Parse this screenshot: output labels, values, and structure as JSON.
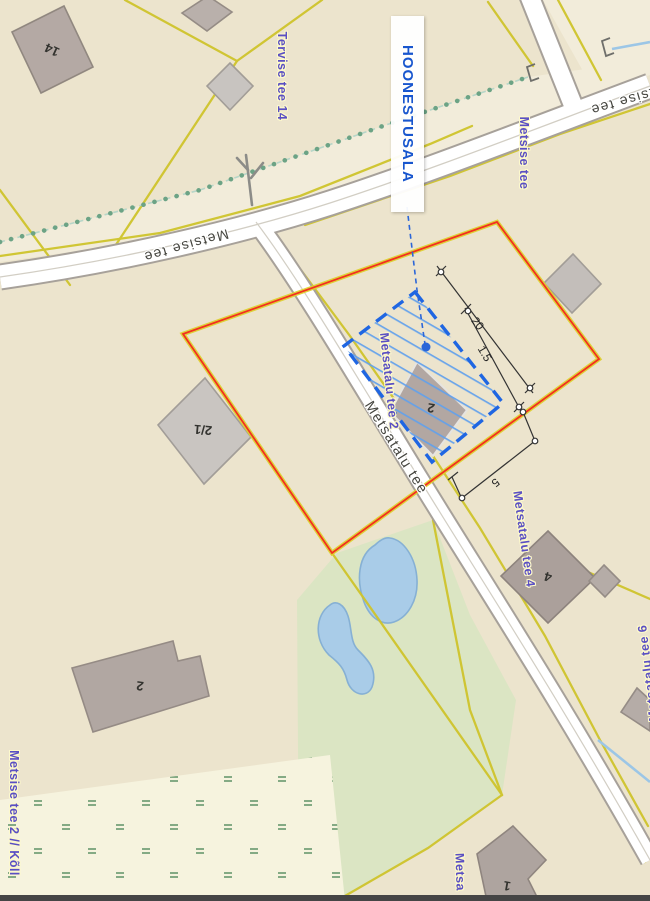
{
  "map": {
    "plan_annotation": {
      "label": "HOONESTUSALA"
    },
    "road_names": {
      "metsise_tee": "Metsise tee",
      "metsatalu_tee": "Metsatalu tee"
    },
    "address_labels": {
      "tervise_tee_14": "Tervise tee 14",
      "metsise_tee": "Metsise tee",
      "metsatalu_tee_2": "Metsatalu tee 2",
      "metsatalu_tee_4": "Metsatalu tee 4",
      "metsatalu_tee_6": "Metsatalu tee 6",
      "metsise_tee_2_kollika": "Metsise tee 2 // Kõll",
      "metsa_partial": "Metsa"
    },
    "dimension_labels": {
      "building_area_length": "20",
      "building_area_offset": "1.5",
      "setback": "5"
    },
    "building_numbers": {
      "b_14": "14",
      "b_2_1": "2/1",
      "b_2_large": "2",
      "b_2_plan": "2",
      "b_4": "4",
      "b_1": "1"
    },
    "colors": {
      "plan_boundary_red": "#f3301f",
      "cadastral_yellow": "#cfc42c",
      "building_area_blue": "#1f66e2",
      "address_label_purple": "#5a4fc3",
      "annotation_blue": "#1856ce",
      "green_area": "#dbe5c3",
      "pond_blue": "#a9cce8",
      "building_gray": "#b2a7a2",
      "wetland_mark_green": "#84aa84"
    }
  }
}
